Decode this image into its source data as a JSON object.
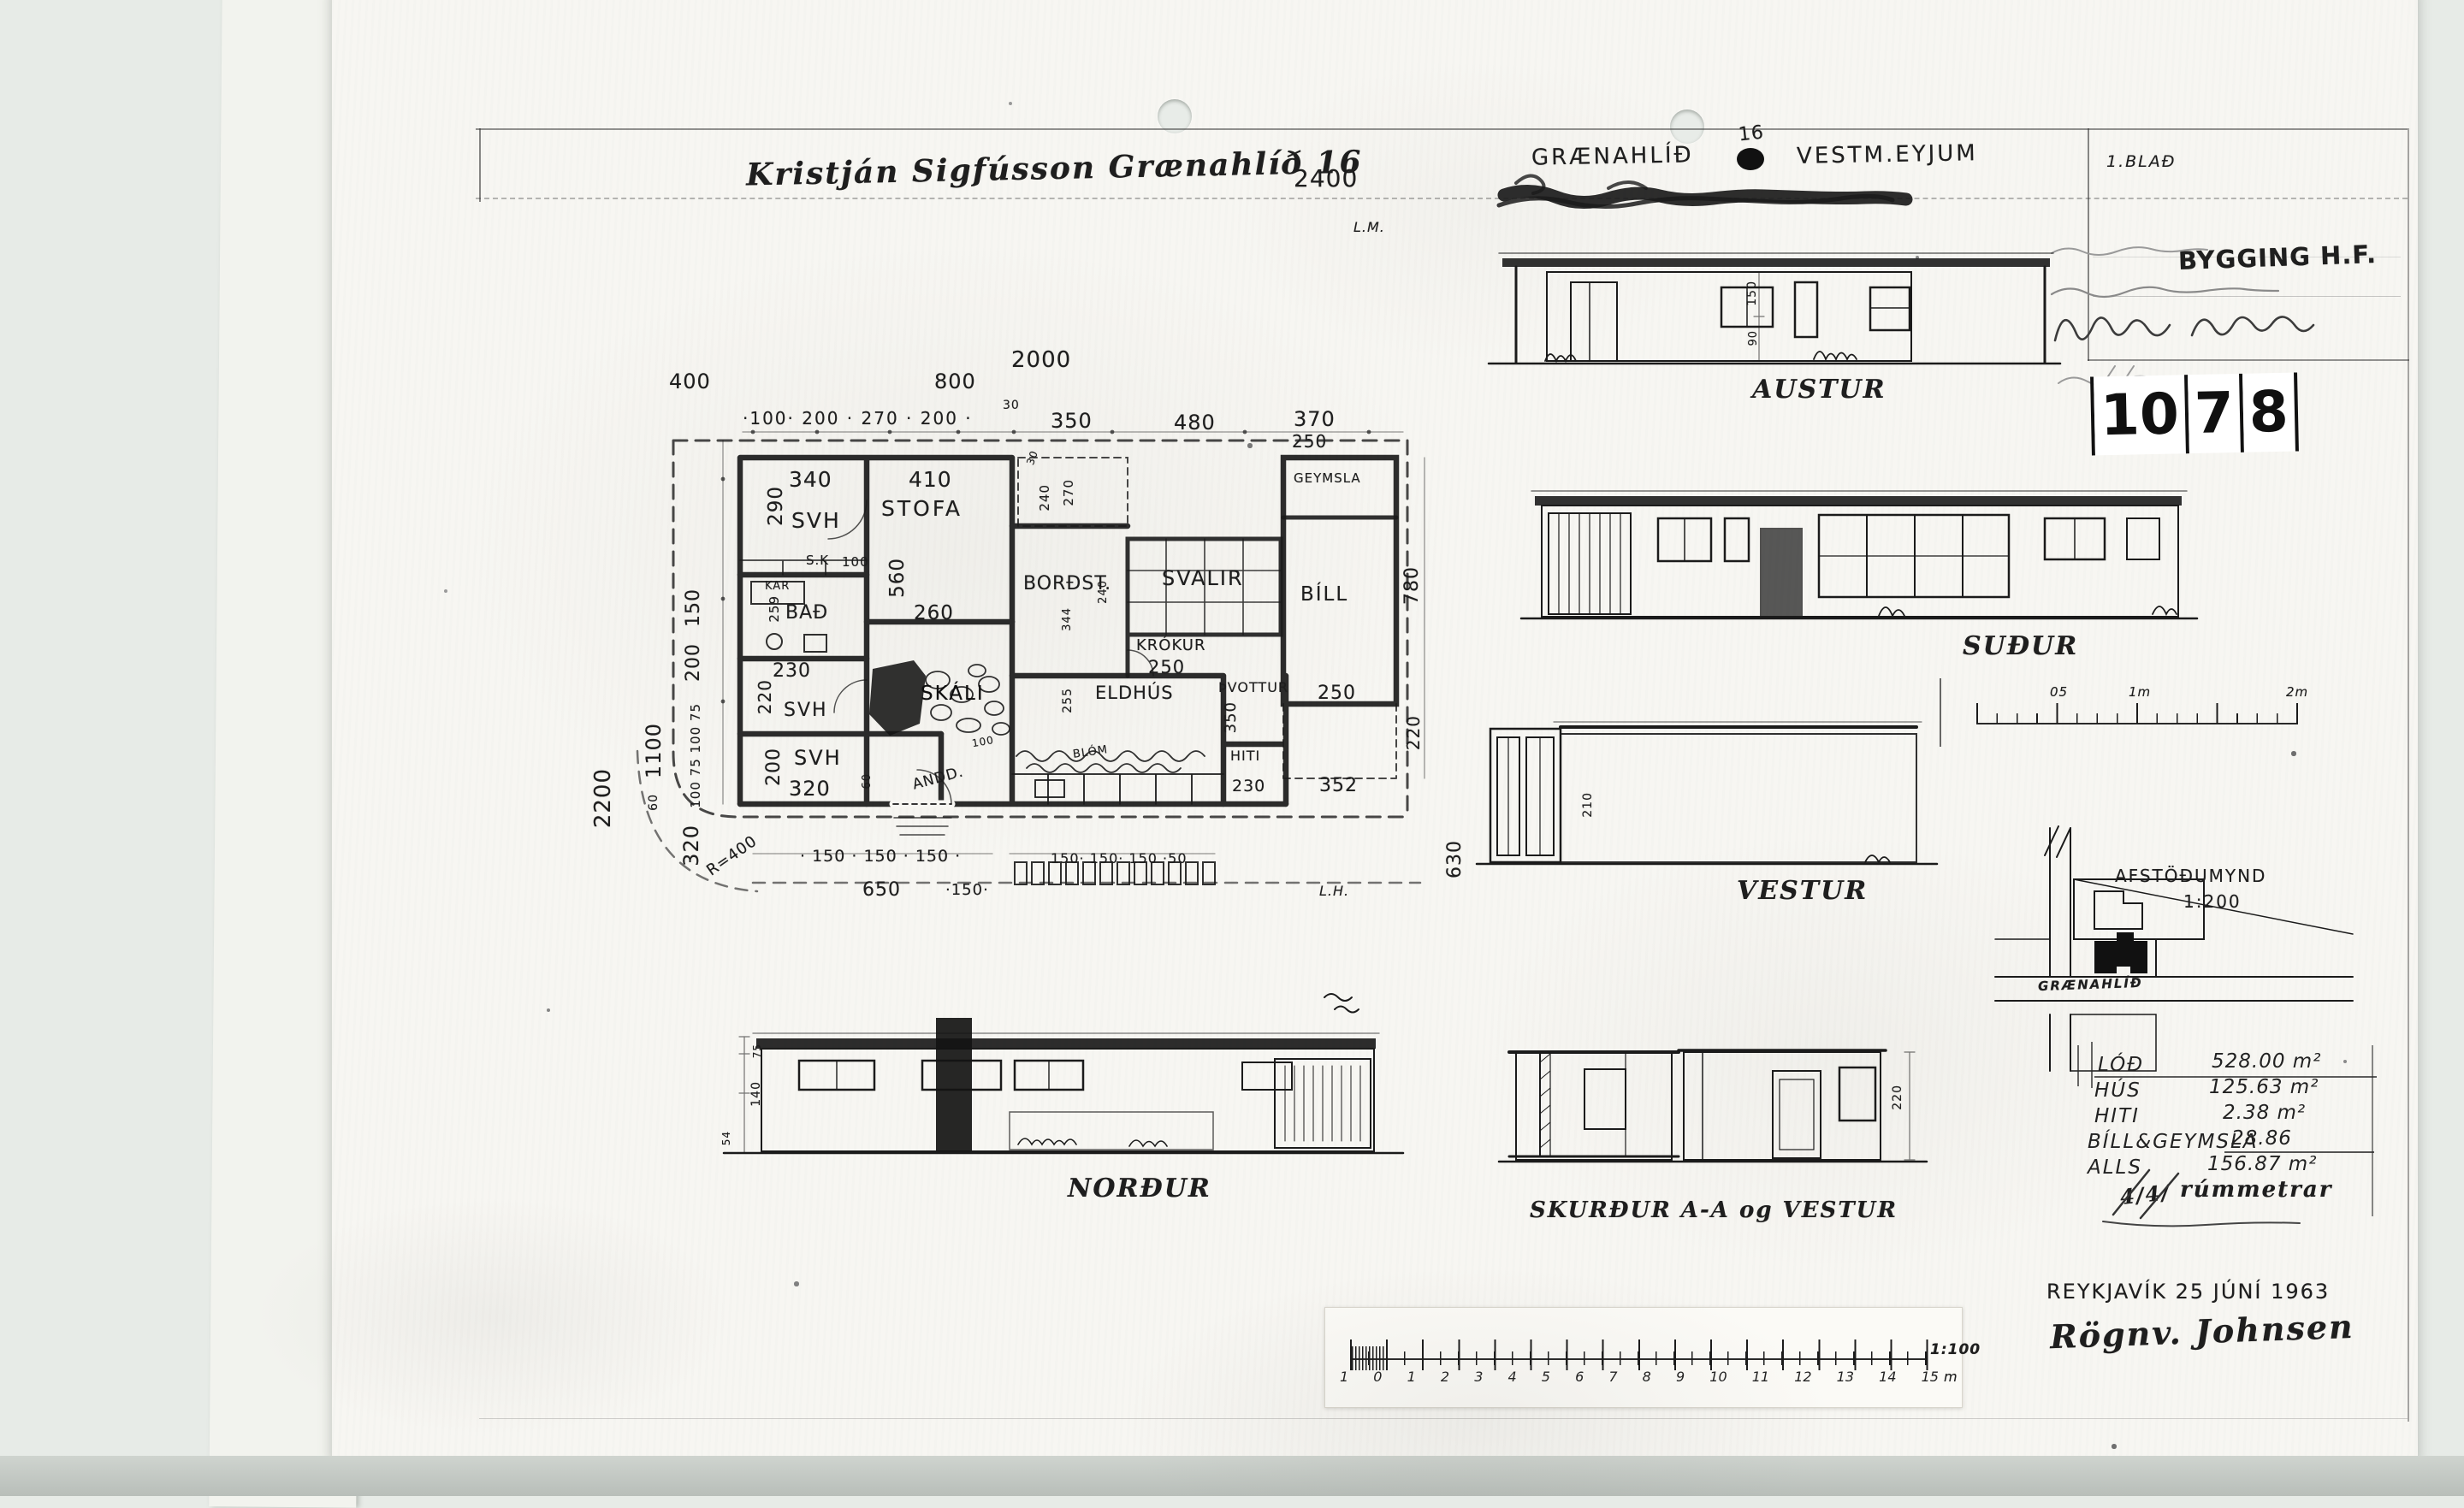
{
  "page": {
    "sheet_label": "1.BLAÐ",
    "sheet_number": "1078",
    "number_groups": [
      "10",
      "7",
      "8"
    ]
  },
  "header": {
    "owner_line": "Kristján Sigfússon  Grænahlíð 16",
    "dim_2400": "2400",
    "marker_top": "L.M.",
    "marker_bottom": "L.H.",
    "site_name": "GRÆNAHLÍÐ",
    "site_number": "16",
    "site_town": "VESTM.EYJUM"
  },
  "titleblock": {
    "stamp": "BYGGING H.F."
  },
  "plan": {
    "dims_top": {
      "d400": "400",
      "d2000": "2000",
      "d800": "800",
      "chain": "·100·  200 ·  270 ·  200 ·",
      "d30": "30",
      "d350": "350",
      "d480": "480",
      "d370": "370",
      "d250": "250"
    },
    "dims_left": {
      "d150": "150",
      "d200": "200",
      "chain": "100 75 100 75",
      "d1100": "1100",
      "d60": "60",
      "d320": "320",
      "radius": "R=400",
      "d2200": "2200"
    },
    "dims_right": {
      "d780": "780",
      "d220": "220",
      "d250": "250",
      "d352": "352",
      "d630": "630"
    },
    "dims_bottom": {
      "chain1": "· 150 · 150 · 150 ·",
      "d650": "650",
      "d150": "·150·",
      "chain2": "150· 150· 150 ·50"
    },
    "rooms": {
      "svh1": "SVH",
      "svh1_w": "340",
      "svh1_h": "290",
      "stofa": "STOFA",
      "stofa_w": "410",
      "stofa_h": "560",
      "stofa_d": "260",
      "sk": "S.K",
      "d100a": "100",
      "kar": "KAR",
      "bad": "BAÐ",
      "bad_h": "259",
      "bordst": "BORÐST.",
      "d344": "344",
      "d240a": "240",
      "d270": "270",
      "d30": "30",
      "d240b": "240",
      "svalir": "SVALIR",
      "geymsla": "GEYMSLA",
      "bill": "BÍLL",
      "krokur": "KRÓKUR",
      "krokur_w": "250",
      "eldhus": "ELDHÚS",
      "eldhus_h": "255",
      "pvottur": "ÞVOTTUR",
      "pvottur_h": "350",
      "hiti": "HITI",
      "hiti_w": "230",
      "skali": "SKÁLI",
      "andd": "ANDD.",
      "blom": "BLÓM",
      "d100b": "100",
      "svh2": "SVH",
      "svh2_w": "230",
      "svh2_h": "220",
      "svh3": "SVH",
      "svh3_w": "320",
      "svh3_h": "200",
      "d60": "60"
    }
  },
  "elevations": {
    "austur": "AUSTUR",
    "sudur": "SUÐUR",
    "vestur": "VESTUR",
    "nordur": "NORÐUR",
    "section": "SKURÐUR A-A  og  VESTUR",
    "dims": {
      "a150": "150",
      "a90": "90",
      "v210": "210",
      "n140": "140",
      "n75": "75",
      "n54": "54",
      "s220": "220"
    }
  },
  "siteplan": {
    "title": "AFSTÖÐUMYND",
    "scale": "1:200",
    "street": "GRÆNAHLÍÐ"
  },
  "areas": {
    "rows": [
      {
        "k": "LÓÐ",
        "v": "528.00 m²"
      },
      {
        "k": "HÚS",
        "v": "125.63 m²"
      },
      {
        "k": "HITI",
        "v": "2.38 m²"
      },
      {
        "k": "BÍLL&GEYMSLA",
        "v": "28.86"
      },
      {
        "k": "ALLS",
        "v": "156.87 m²"
      }
    ],
    "note_prefix": "4/4/",
    "note": "rúmmetrar"
  },
  "footer": {
    "place_date": "REYKJAVÍK  25 JÚNÍ 1963",
    "signature": "Rögnv. Johnsen"
  },
  "scalebar_small": {
    "l05": "05",
    "l1m": "1m",
    "l2m": "2m"
  },
  "scalebar_main": {
    "labels": [
      "1",
      "0",
      "1",
      "2",
      "3",
      "4",
      "5",
      "6",
      "7",
      "8",
      "9",
      "10",
      "11",
      "12",
      "13",
      "14",
      "15"
    ],
    "unit": "m",
    "ratio": "1:100"
  }
}
